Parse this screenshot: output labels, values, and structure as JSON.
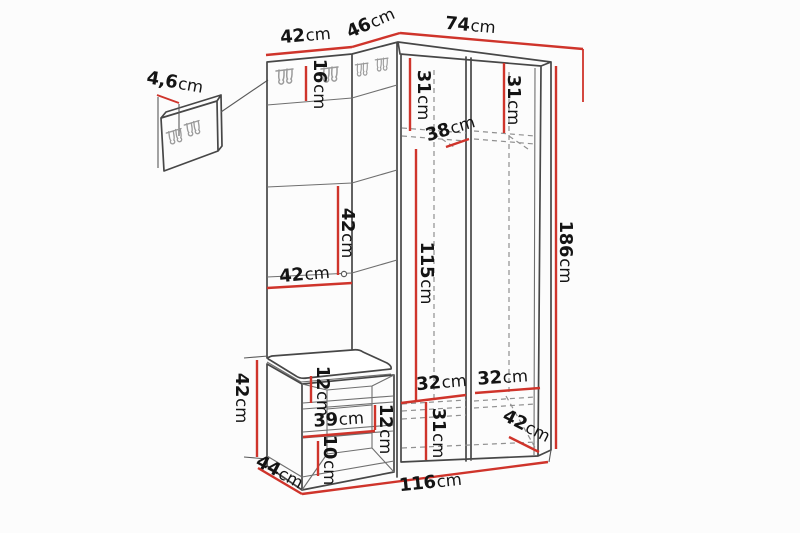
{
  "diagram": {
    "kind": "furniture-dimension-drawing",
    "subject": "hallway wardrobe set with hook panel, corner wardrobe and bench"
  },
  "colors": {
    "dimension": "#cf342b",
    "outline": "#474747",
    "hidden": "#909090",
    "background": "#fcfcfc",
    "text": "#141414"
  },
  "dims": {
    "panel_thickness": {
      "value": "4,6",
      "unit": "cm"
    },
    "top_left_width": {
      "value": "42",
      "unit": "cm"
    },
    "corner_width": {
      "value": "46",
      "unit": "cm"
    },
    "top_right_width": {
      "value": "74",
      "unit": "cm"
    },
    "hook_rail_height": {
      "value": "16",
      "unit": "cm"
    },
    "upper_shelf_left_height": {
      "value": "31",
      "unit": "cm"
    },
    "upper_shelf_right_height": {
      "value": "31",
      "unit": "cm"
    },
    "shelf_depth": {
      "value": "38",
      "unit": "cm"
    },
    "interior_height": {
      "value": "115",
      "unit": "cm"
    },
    "total_height": {
      "value": "186",
      "unit": "cm"
    },
    "panel_section_height": {
      "value": "42",
      "unit": "cm"
    },
    "panel_width": {
      "value": "42",
      "unit": "cm"
    },
    "bench_height": {
      "value": "42",
      "unit": "cm"
    },
    "bench_top_gap": {
      "value": "12",
      "unit": "cm"
    },
    "bench_opening_width": {
      "value": "39",
      "unit": "cm"
    },
    "bench_mid_gap": {
      "value": "12",
      "unit": "cm"
    },
    "bench_bottom_gap": {
      "value": "10",
      "unit": "cm"
    },
    "bench_depth": {
      "value": "44",
      "unit": "cm"
    },
    "total_width": {
      "value": "116",
      "unit": "cm"
    },
    "compartment_left_width": {
      "value": "32",
      "unit": "cm"
    },
    "compartment_right_width": {
      "value": "32",
      "unit": "cm"
    },
    "lower_compartment_height": {
      "value": "31",
      "unit": "cm"
    },
    "wardrobe_depth": {
      "value": "42",
      "unit": "cm"
    }
  }
}
